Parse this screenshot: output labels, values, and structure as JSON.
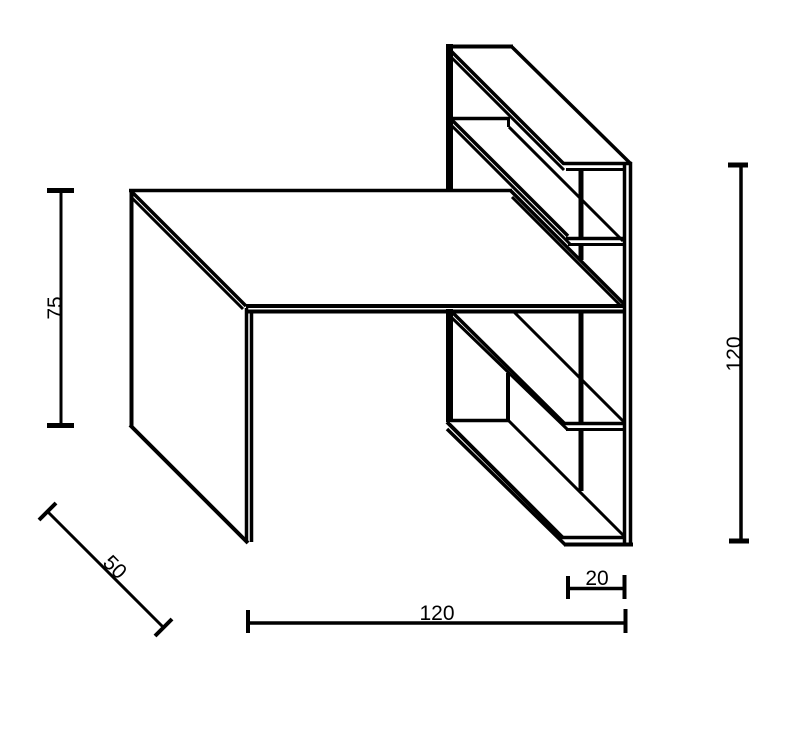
{
  "canvas": {
    "width": 789,
    "height": 741,
    "background_color": "#ffffff",
    "line_color": "#000000"
  },
  "figure": {
    "kind": "technical-line-drawing",
    "subject": "desk with staggered wall shelf unit"
  },
  "dimensions": [
    {
      "id": "desk-height",
      "label": "75",
      "orientation": "vertical"
    },
    {
      "id": "desk-depth",
      "label": "50",
      "orientation": "diagonal-45"
    },
    {
      "id": "desk-width",
      "label": "120",
      "orientation": "horizontal"
    },
    {
      "id": "shelf-depth",
      "label": "20",
      "orientation": "horizontal"
    },
    {
      "id": "shelf-height",
      "label": "120",
      "orientation": "vertical"
    }
  ]
}
